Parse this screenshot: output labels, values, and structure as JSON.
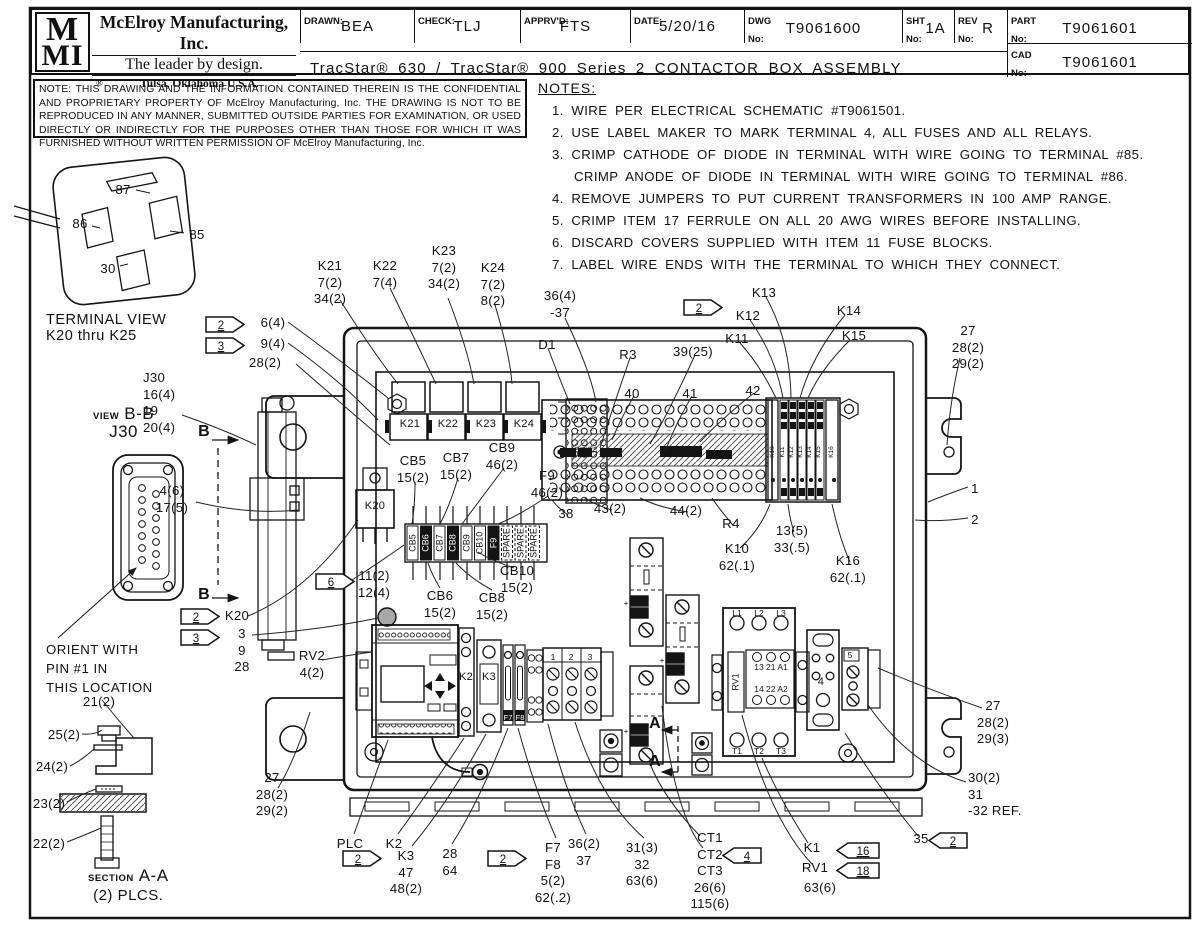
{
  "sheet": {
    "logo_top": "M",
    "logo_mid": "MI",
    "reg": "®",
    "company": "McElroy Manufacturing, Inc.",
    "tagline": "The leader by design.",
    "location": "Tulsa, Oklahoma U.S.A.",
    "drawn_label": "DRAWN:",
    "drawn": "BEA",
    "check_label": "CHECK:",
    "check": "TLJ",
    "apprvd_label": "APPRV'D:",
    "apprvd": "FTS",
    "date_label": "DATE:",
    "date": "5/20/16",
    "dwg_label": "DWG\nNo:",
    "dwg": "T9061600",
    "sht_label": "SHT\nNo:",
    "sht": "1A",
    "rev_label": "REV\nNo:",
    "rev": "R",
    "part_label": "PART\nNo:",
    "part": "T9061601",
    "cad_label": "CAD\nNo:",
    "cad": "T9061601",
    "drawing_title": "TracStar® 630 / TracStar® 900 Series 2 CONTACTOR BOX ASSEMBLY"
  },
  "confidentiality_note": "NOTE: THIS DRAWING AND THE INFORMATION CONTAINED THEREIN IS THE CONFIDENTIAL AND PROPRIETARY PROPERTY OF McElroy Manufacturing, Inc. THE DRAWING IS NOT TO BE REPRODUCED IN ANY MANNER, SUBMITTED OUTSIDE PARTIES FOR EXAMINATION, OR USED DIRECTLY OR INDIRECTLY FOR THE PURPOSES OTHER THAN THOSE FOR WHICH IT WAS FURNISHED WITHOUT WRITTEN PERMISSION OF McElroy Manufacturing, Inc.",
  "notes": {
    "heading": "NOTES:",
    "items": [
      {
        "text": "1. WIRE PER ELECTRICAL SCHEMATIC #T9061501.",
        "cont": false
      },
      {
        "text": "2. USE LABEL MAKER TO MARK TERMINAL 4, ALL FUSES  AND ALL RELAYS.",
        "cont": false
      },
      {
        "text": "3. CRIMP CATHODE OF DIODE IN TERMINAL WITH WIRE GOING TO TERMINAL #85.",
        "cont": false
      },
      {
        "text": "CRIMP ANODE OF DIODE IN TERMINAL WITH WIRE GOING TO TERMINAL #86.",
        "cont": true
      },
      {
        "text": "4. REMOVE JUMPERS TO PUT CURRENT TRANSFORMERS IN 100 AMP RANGE.",
        "cont": false
      },
      {
        "text": "5. CRIMP ITEM 17 FERRULE ON ALL 20 AWG WIRES BEFORE INSTALLING.",
        "cont": false
      },
      {
        "text": "6. DISCARD COVERS SUPPLIED WITH ITEM 11 FUSE BLOCKS.",
        "cont": false
      },
      {
        "text": "7. LABEL WIRE ENDS WITH THE TERMINAL TO WHICH THEY CONNECT.",
        "cont": false
      }
    ]
  },
  "views": {
    "terminal_view": {
      "line1": "TERMINAL VIEW",
      "line2": "K20 thru K25"
    },
    "view_bb": {
      "prefix": "VIEW",
      "name": "B-B",
      "connector": "J30",
      "orient_note": "ORIENT WITH\nPIN #1 IN\nTHIS LOCATION"
    },
    "section_aa": {
      "prefix": "SECTION",
      "name": "A-A",
      "places": "(2) PLCS."
    }
  },
  "colors": {
    "line": "#141414",
    "paper": "#ffffff",
    "knob_gray": "#a8a8a8"
  },
  "callouts": [
    {
      "t": "K21\n7(2)\n34(2)",
      "x": 330,
      "y": 258
    },
    {
      "t": "K22\n7(4)",
      "x": 385,
      "y": 258
    },
    {
      "t": "K23\n7(2)\n34(2)",
      "x": 444,
      "y": 243
    },
    {
      "t": "K24\n7(2)\n8(2)",
      "x": 493,
      "y": 260
    },
    {
      "t": "36(4)\n-37",
      "x": 560,
      "y": 288
    },
    {
      "t": "D1",
      "x": 547,
      "y": 337
    },
    {
      "t": "R3",
      "x": 628,
      "y": 347
    },
    {
      "t": "39(25)",
      "x": 693,
      "y": 344
    },
    {
      "t": "K11",
      "x": 737,
      "y": 331
    },
    {
      "t": "K12",
      "x": 748,
      "y": 308
    },
    {
      "t": "K13",
      "x": 764,
      "y": 285
    },
    {
      "t": "K14",
      "x": 849,
      "y": 303
    },
    {
      "t": "K15",
      "x": 854,
      "y": 328
    },
    {
      "t": "27\n28(2)\n29(2)",
      "x": 968,
      "y": 323
    },
    {
      "t": "6(4)",
      "x": 273,
      "y": 315
    },
    {
      "t": "9(4)",
      "x": 273,
      "y": 336
    },
    {
      "t": "28(2)",
      "x": 265,
      "y": 355
    },
    {
      "t": "J30\n16(4)\n19\n20(4)",
      "x": 143,
      "y": 370,
      "cls": "left"
    },
    {
      "t": "4(6)\n17(5)",
      "x": 172,
      "y": 483
    },
    {
      "t": "B",
      "x": 204,
      "y": 422,
      "cls": "big"
    },
    {
      "t": "B",
      "x": 204,
      "y": 585,
      "cls": "big"
    },
    {
      "t": "CB5\n15(2)",
      "x": 413,
      "y": 453
    },
    {
      "t": "CB7\n15(2)",
      "x": 456,
      "y": 450
    },
    {
      "t": "CB9\n46(2)",
      "x": 502,
      "y": 440
    },
    {
      "t": "F9\n46(2)",
      "x": 547,
      "y": 468
    },
    {
      "t": "40",
      "x": 632,
      "y": 386
    },
    {
      "t": "41",
      "x": 690,
      "y": 386
    },
    {
      "t": "42",
      "x": 753,
      "y": 383
    },
    {
      "t": "38",
      "x": 566,
      "y": 506
    },
    {
      "t": "43(2)",
      "x": 610,
      "y": 501
    },
    {
      "t": "44(2)",
      "x": 686,
      "y": 503
    },
    {
      "t": "R4",
      "x": 731,
      "y": 516
    },
    {
      "t": "K10\n62(.1)",
      "x": 737,
      "y": 541
    },
    {
      "t": "13(5)\n33(.5)",
      "x": 792,
      "y": 523
    },
    {
      "t": "K16\n62(.1)",
      "x": 848,
      "y": 553
    },
    {
      "t": "1",
      "x": 975,
      "y": 481
    },
    {
      "t": "2",
      "x": 975,
      "y": 512
    },
    {
      "t": "11(2)\n12(4)",
      "x": 374,
      "y": 568
    },
    {
      "t": "CB10\n15(2)",
      "x": 517,
      "y": 563
    },
    {
      "t": "CB6\n15(2)",
      "x": 440,
      "y": 588
    },
    {
      "t": "CB8\n15(2)",
      "x": 492,
      "y": 590
    },
    {
      "t": "K20",
      "x": 237,
      "y": 608
    },
    {
      "t": "3\n9\n28",
      "x": 242,
      "y": 626
    },
    {
      "t": "RV2\n4(2)",
      "x": 312,
      "y": 648
    },
    {
      "t": "21(2)",
      "x": 99,
      "y": 694
    },
    {
      "t": "25(2)",
      "x": 64,
      "y": 727
    },
    {
      "t": "24(2)",
      "x": 52,
      "y": 759
    },
    {
      "t": "23(2)",
      "x": 49,
      "y": 796
    },
    {
      "t": "22(2)",
      "x": 49,
      "y": 836
    },
    {
      "t": "27\n28(2)\n29(2)",
      "x": 272,
      "y": 770
    },
    {
      "t": "PLC",
      "x": 350,
      "y": 836
    },
    {
      "t": "K2",
      "x": 394,
      "y": 836
    },
    {
      "t": "K3\n47\n48(2)",
      "x": 406,
      "y": 848
    },
    {
      "t": "28\n64",
      "x": 450,
      "y": 846
    },
    {
      "t": "F7\nF8\n5(2)\n62(.2)",
      "x": 553,
      "y": 840
    },
    {
      "t": "36(2)\n37",
      "x": 584,
      "y": 836
    },
    {
      "t": "31(3)\n32\n63(6)",
      "x": 642,
      "y": 840
    },
    {
      "t": "CT1\nCT2\nCT3\n26(6)\n115(6)",
      "x": 710,
      "y": 830
    },
    {
      "t": "K1",
      "x": 812,
      "y": 840
    },
    {
      "t": "RV1",
      "x": 815,
      "y": 860
    },
    {
      "t": "63(6)",
      "x": 820,
      "y": 880
    },
    {
      "t": "35",
      "x": 921,
      "y": 831
    },
    {
      "t": "30(2)\n31\n-32 REF.",
      "x": 968,
      "y": 770,
      "cls": "left"
    },
    {
      "t": "27\n28(2)\n29(3)",
      "x": 993,
      "y": 698
    },
    {
      "t": "87",
      "x": 123,
      "y": 182
    },
    {
      "t": "86",
      "x": 80,
      "y": 216
    },
    {
      "t": "85",
      "x": 197,
      "y": 227
    },
    {
      "t": "30",
      "x": 108,
      "y": 261
    },
    {
      "t": "K21",
      "x": 410,
      "y": 418,
      "cls": "sm"
    },
    {
      "t": "K22",
      "x": 448,
      "y": 418,
      "cls": "sm"
    },
    {
      "t": "K23",
      "x": 486,
      "y": 418,
      "cls": "sm"
    },
    {
      "t": "K24",
      "x": 524,
      "y": 418,
      "cls": "sm"
    },
    {
      "t": "K20",
      "x": 375,
      "y": 500,
      "cls": "sm"
    },
    {
      "t": "K2",
      "x": 466,
      "y": 671,
      "cls": "sm"
    },
    {
      "t": "K3",
      "x": 489,
      "y": 671,
      "cls": "sm"
    },
    {
      "t": "4",
      "x": 821,
      "y": 676,
      "cls": "sm"
    },
    {
      "t": "A",
      "x": 655,
      "y": 714,
      "cls": "big"
    },
    {
      "t": "A",
      "x": 655,
      "y": 752,
      "cls": "big"
    },
    {
      "t": "CB5",
      "x": 413,
      "y": 543,
      "cls": "v"
    },
    {
      "t": "CB6",
      "x": 426,
      "y": 543,
      "cls": "v w"
    },
    {
      "t": "CB7",
      "x": 440,
      "y": 543,
      "cls": "v"
    },
    {
      "t": "CB8",
      "x": 453,
      "y": 543,
      "cls": "v w"
    },
    {
      "t": "CB9",
      "x": 467,
      "y": 543,
      "cls": "v"
    },
    {
      "t": "CB10",
      "x": 480,
      "y": 543,
      "cls": "v"
    },
    {
      "t": "F9",
      "x": 494,
      "y": 543,
      "cls": "v w"
    },
    {
      "t": "SPARE",
      "x": 507,
      "y": 543,
      "cls": "v"
    },
    {
      "t": "SPARE",
      "x": 521,
      "y": 543,
      "cls": "v"
    },
    {
      "t": "SPARE",
      "x": 534,
      "y": 543,
      "cls": "v"
    },
    {
      "t": "K10",
      "x": 773,
      "y": 452,
      "cls": "vt"
    },
    {
      "t": "K11",
      "x": 783,
      "y": 452,
      "cls": "vt"
    },
    {
      "t": "K12",
      "x": 792,
      "y": 452,
      "cls": "vt"
    },
    {
      "t": "K13",
      "x": 801,
      "y": 452,
      "cls": "vt"
    },
    {
      "t": "K14",
      "x": 810,
      "y": 452,
      "cls": "vt"
    },
    {
      "t": "K15",
      "x": 819,
      "y": 452,
      "cls": "vt"
    },
    {
      "t": "K16",
      "x": 832,
      "y": 452,
      "cls": "vt"
    },
    {
      "t": "13",
      "x": 578,
      "y": 450,
      "cls": "vt"
    },
    {
      "t": "14",
      "x": 584,
      "y": 450,
      "cls": "vt"
    },
    {
      "t": "15",
      "x": 590,
      "y": 450,
      "cls": "vt"
    },
    {
      "t": "16",
      "x": 596,
      "y": 450,
      "cls": "vt"
    },
    {
      "t": "RV1",
      "x": 736,
      "y": 682,
      "cls": "v"
    },
    {
      "t": "F7",
      "x": 508,
      "y": 713,
      "cls": "tinyw"
    },
    {
      "t": "F8",
      "x": 520,
      "y": 713,
      "cls": "tinyw"
    },
    {
      "t": "1",
      "x": 553,
      "y": 652,
      "cls": "tiny"
    },
    {
      "t": "2",
      "x": 571,
      "y": 652,
      "cls": "tiny"
    },
    {
      "t": "3",
      "x": 590,
      "y": 652,
      "cls": "tiny"
    },
    {
      "t": "5",
      "x": 850,
      "y": 650,
      "cls": "tiny"
    },
    {
      "t": "L1",
      "x": 737,
      "y": 608,
      "cls": "tiny"
    },
    {
      "t": "L2",
      "x": 759,
      "y": 608,
      "cls": "tiny"
    },
    {
      "t": "L3",
      "x": 781,
      "y": 608,
      "cls": "tiny"
    },
    {
      "t": "13 21 A1",
      "x": 771,
      "y": 662,
      "cls": "tiny"
    },
    {
      "t": "14 22 A2",
      "x": 771,
      "y": 684,
      "cls": "tiny"
    },
    {
      "t": "T1",
      "x": 737,
      "y": 746,
      "cls": "tiny"
    },
    {
      "t": "T2",
      "x": 759,
      "y": 746,
      "cls": "tiny"
    },
    {
      "t": "T3",
      "x": 781,
      "y": 746,
      "cls": "tiny"
    },
    {
      "t": "+",
      "x": 626,
      "y": 598,
      "cls": "tiny"
    },
    {
      "t": "+",
      "x": 662,
      "y": 655,
      "cls": "tiny"
    },
    {
      "t": "+",
      "x": 626,
      "y": 726,
      "cls": "tiny"
    }
  ],
  "flags": [
    {
      "n": "2",
      "x": 205,
      "y": 316,
      "dir": "r"
    },
    {
      "n": "3",
      "x": 205,
      "y": 337,
      "dir": "r"
    },
    {
      "n": "2",
      "x": 683,
      "y": 299,
      "dir": "r"
    },
    {
      "n": "6",
      "x": 315,
      "y": 573,
      "dir": "r"
    },
    {
      "n": "2",
      "x": 180,
      "y": 608,
      "dir": "r"
    },
    {
      "n": "3",
      "x": 180,
      "y": 629,
      "dir": "r"
    },
    {
      "n": "2",
      "x": 342,
      "y": 850,
      "dir": "r"
    },
    {
      "n": "2",
      "x": 487,
      "y": 850,
      "dir": "r"
    },
    {
      "n": "4",
      "x": 722,
      "y": 847,
      "dir": "l"
    },
    {
      "n": "16",
      "x": 836,
      "y": 842,
      "dir": "l"
    },
    {
      "n": "18",
      "x": 836,
      "y": 862,
      "dir": "l"
    },
    {
      "n": "2",
      "x": 928,
      "y": 832,
      "dir": "l"
    }
  ]
}
